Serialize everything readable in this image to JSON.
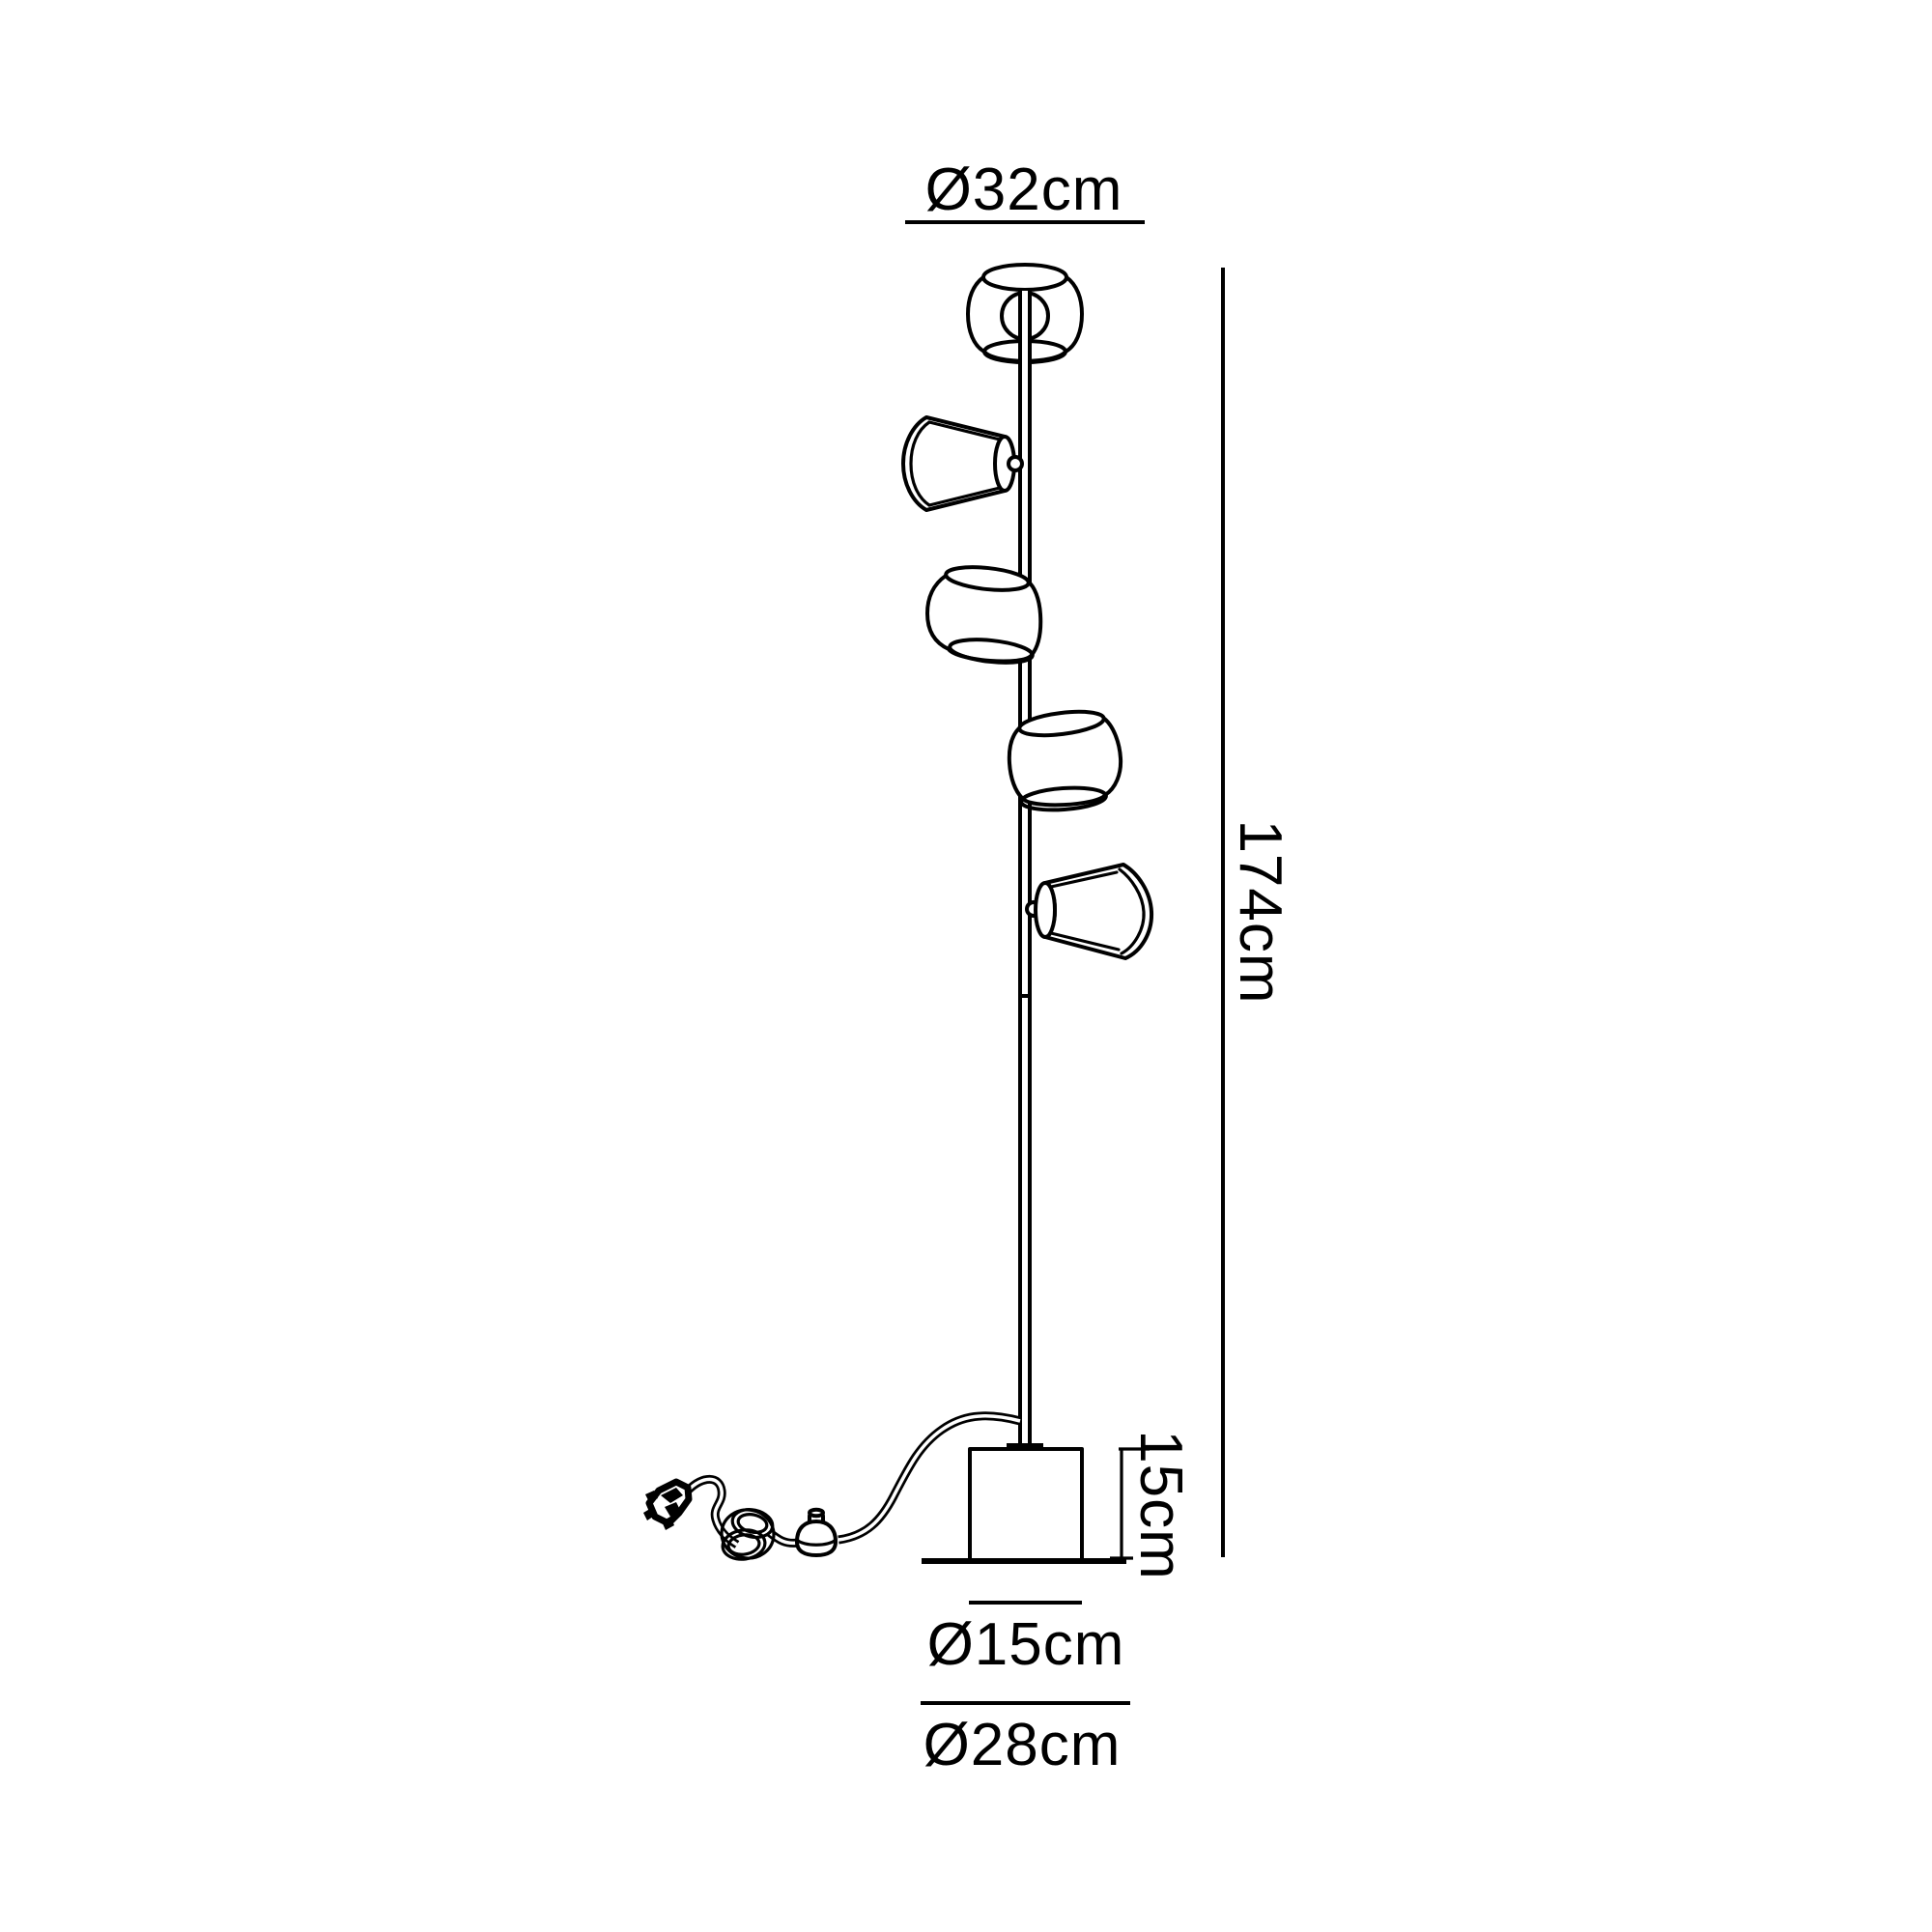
{
  "diagram": {
    "background": "#ffffff",
    "line_color": "#000000",
    "text_color": "#000000",
    "labels": {
      "shade_diameter": "Ø32cm",
      "overall_height": "174cm",
      "base_height": "15cm",
      "base_diameter": "Ø15cm",
      "footprint_diameter": "Ø28cm"
    }
  }
}
